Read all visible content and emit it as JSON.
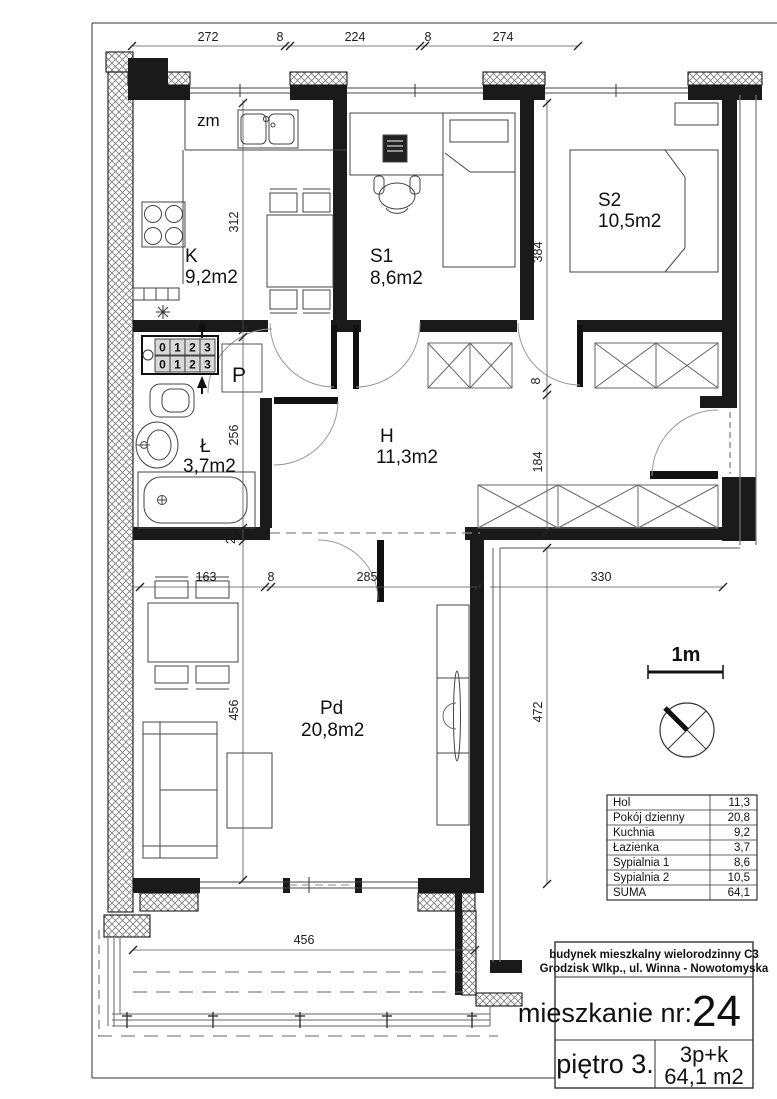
{
  "plan": {
    "labels": {
      "zm": "zm",
      "kitchen": {
        "name": "K",
        "area": "9,2m2"
      },
      "bedroom1": {
        "name": "S1",
        "area": "8,6m2"
      },
      "bedroom2": {
        "name": "S2",
        "area": "10,5m2"
      },
      "bathroom": {
        "name": "Ł",
        "area": "3,7m2"
      },
      "hall": {
        "name": "H",
        "area": "11,3m2"
      },
      "living": {
        "name": "Pd",
        "area": "20,8m2"
      },
      "storage": "P"
    },
    "dimensions": {
      "top": [
        "272",
        "8",
        "224",
        "8",
        "274"
      ],
      "left_chain": [
        "312",
        "8",
        "256",
        "24",
        "456"
      ],
      "right_chain": [
        "384",
        "8",
        "184",
        "472"
      ],
      "bottom_chain": [
        "163",
        "8",
        "285"
      ],
      "corridor": "330",
      "balcony": "456"
    },
    "meter_digits": [
      "0",
      "1",
      "2",
      "3"
    ],
    "scale_label": "1m",
    "colors": {
      "ink": "#1a1a1a",
      "paper": "#ffffff",
      "furniture": "#555555"
    }
  },
  "legend_table": {
    "rows": [
      {
        "label": "Hol",
        "value": "11,3"
      },
      {
        "label": "Pokój dzienny",
        "value": "20,8"
      },
      {
        "label": "Kuchnia",
        "value": "9,2"
      },
      {
        "label": "Łazienka",
        "value": "3,7"
      },
      {
        "label": "Sypialnia 1",
        "value": "8,6"
      },
      {
        "label": "Sypialnia 2",
        "value": "10,5"
      },
      {
        "label": "SUMA",
        "value": "64,1"
      }
    ]
  },
  "title_block": {
    "building_line1": "budynek mieszkalny wielorodzinny C3",
    "building_line2": "Grodzisk Wlkp., ul. Winna - Nowotomyska",
    "apartment_label": "mieszkanie nr:",
    "apartment_number": "24",
    "floor": "piętro 3.",
    "layout": "3p+k",
    "area": "64,1 m2"
  }
}
